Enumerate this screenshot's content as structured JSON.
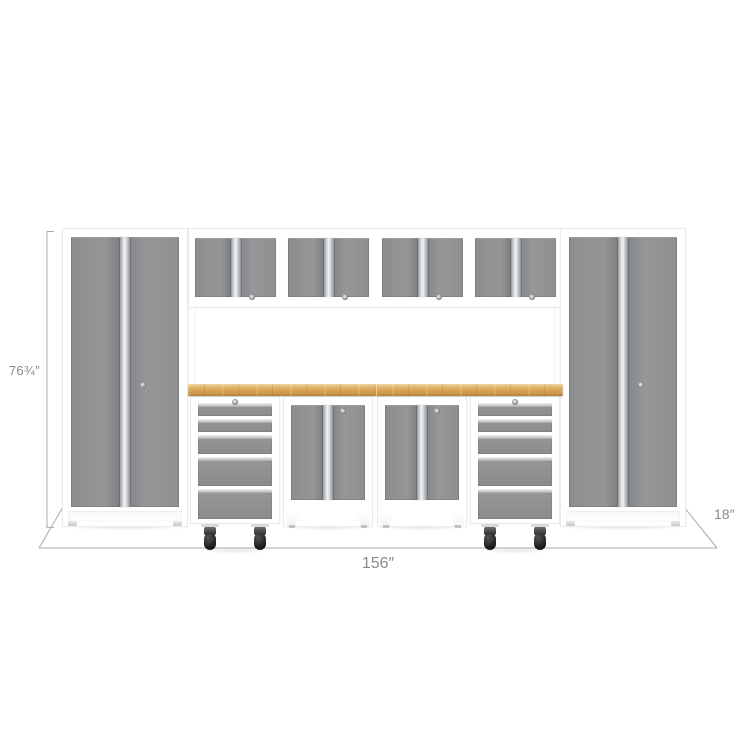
{
  "scene": {
    "title": "garage-cabinet-set-dimension-diagram",
    "units": [
      {
        "name": "tall-locker-left",
        "type": "2-door tall locker cabinet"
      },
      {
        "name": "wall-cabinet-1",
        "type": "2-door wall cabinet"
      },
      {
        "name": "wall-cabinet-2",
        "type": "2-door wall cabinet"
      },
      {
        "name": "wall-cabinet-3",
        "type": "2-door wall cabinet"
      },
      {
        "name": "wall-cabinet-4",
        "type": "2-door wall cabinet"
      },
      {
        "name": "bamboo-worktop",
        "type": "wood worktop"
      },
      {
        "name": "drawer-unit-left",
        "type": "5-drawer tool cabinet on casters"
      },
      {
        "name": "base-cabinet-left",
        "type": "2-door base cabinet"
      },
      {
        "name": "base-cabinet-right",
        "type": "2-door base cabinet"
      },
      {
        "name": "drawer-unit-right",
        "type": "5-drawer tool cabinet on casters"
      },
      {
        "name": "tall-locker-right",
        "type": "2-door tall locker cabinet"
      }
    ]
  },
  "dimensions": {
    "height_label": "76¾″",
    "width_label": "156″",
    "depth_label": "18″"
  },
  "colors": {
    "background": "#ffffff",
    "frame_white": "#ffffff",
    "door_gray": "#8f9193",
    "worktop_wood": "#d8a75c",
    "caster_black": "#1a1a1a",
    "dimension_line": "#ababab",
    "dimension_text": "#8a8a8a"
  }
}
